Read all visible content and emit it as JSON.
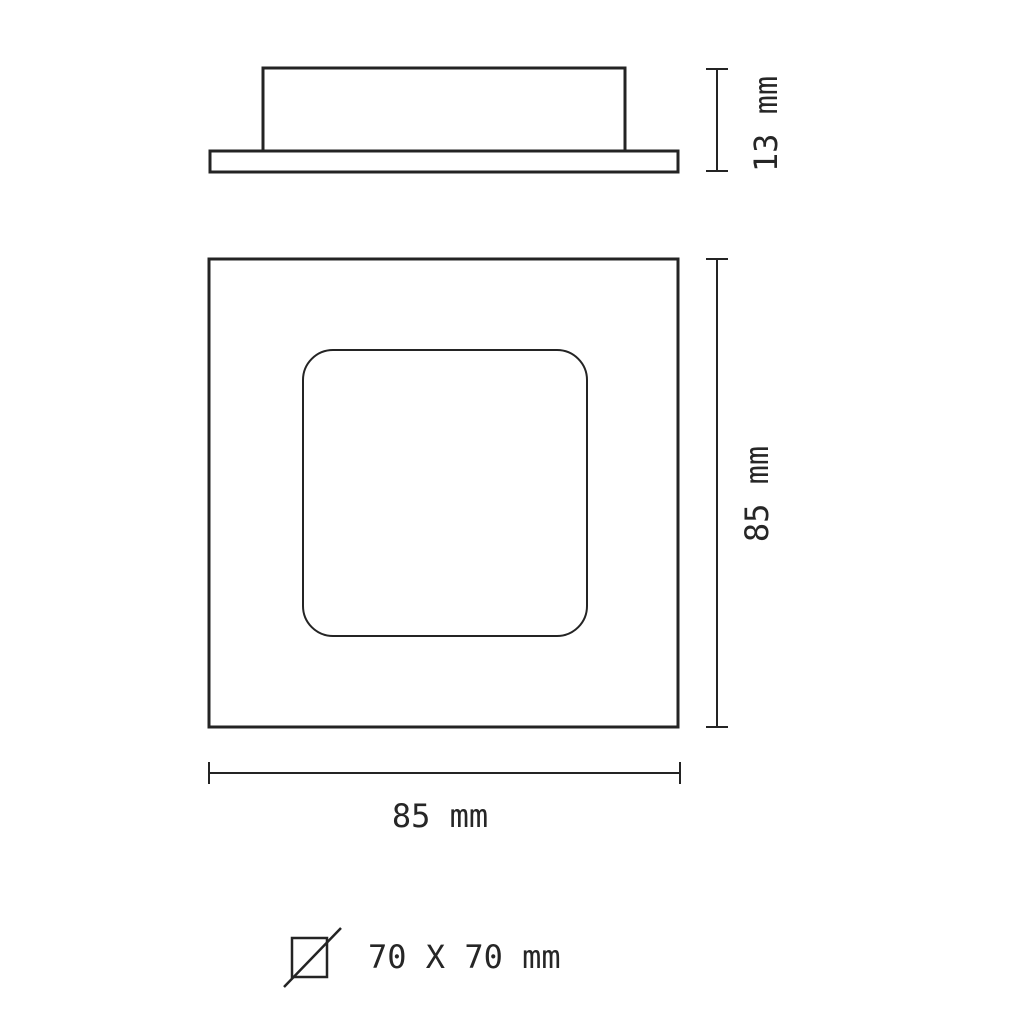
{
  "page": {
    "background": "#ffffff",
    "line_color": "#242424",
    "text_color": "#262626"
  },
  "side_view": {
    "description": "side profile of fixture with base plate",
    "height_label": "13 mm"
  },
  "front_view": {
    "description": "front face 85 x 85 square with rounded inner recess",
    "height_label": "85 mm",
    "width_label": "85 mm"
  },
  "cutout_note": {
    "icon": "square-cutout-icon",
    "label": "70 X 70 mm"
  }
}
